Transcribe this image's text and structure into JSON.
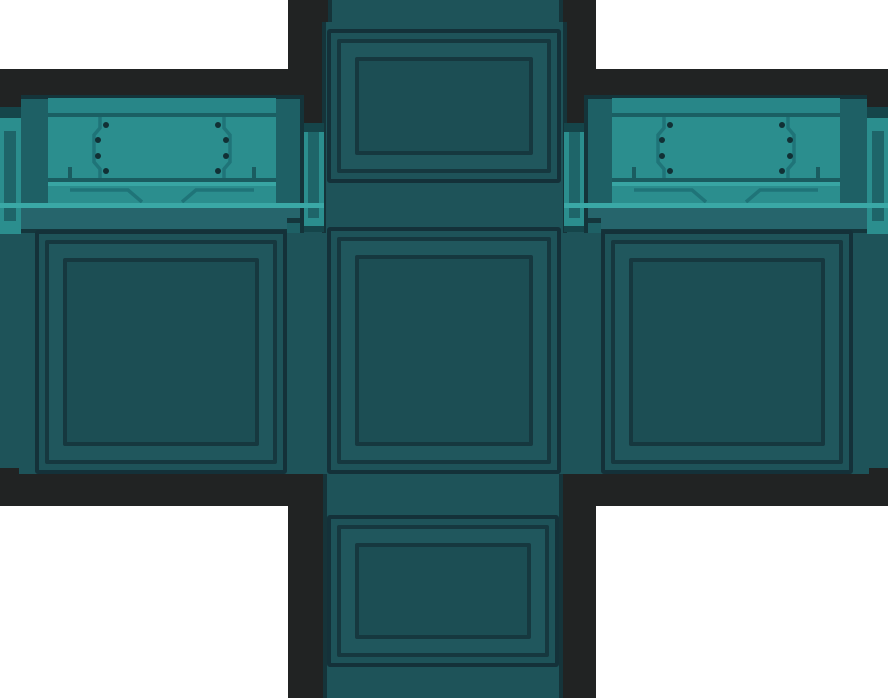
{
  "scene": {
    "kind": "game-texture-sprite",
    "subject": "unwrapped sci-fi crate (cube net) with riveted teal lid plates"
  },
  "palette": {
    "bg_white": "#FFFFFF",
    "border_black": "#212323",
    "face_base": "#1E5359",
    "panel_field": "#1C4E54",
    "panel_strip": "#20575D",
    "panel_groove": "#16383F",
    "panel_outline": "#143139",
    "column_edge": "#15343A",
    "body": "#1E6065",
    "dark_line": "#14343A",
    "lip_band": "#26656C",
    "lip_dark": "#14363C",
    "lid_bar": "#288688",
    "lid_plate": "#2B8E8E",
    "lid_groove": "#1A5F63",
    "plate_shadow": "#1A5C60",
    "highlight": "#38A5A3",
    "lip_highlight": "#3AA8A6",
    "tab_cap": "#15454A",
    "tab_inner": "#1E6569",
    "seam": "#1F7478",
    "rivet": "#113035"
  }
}
